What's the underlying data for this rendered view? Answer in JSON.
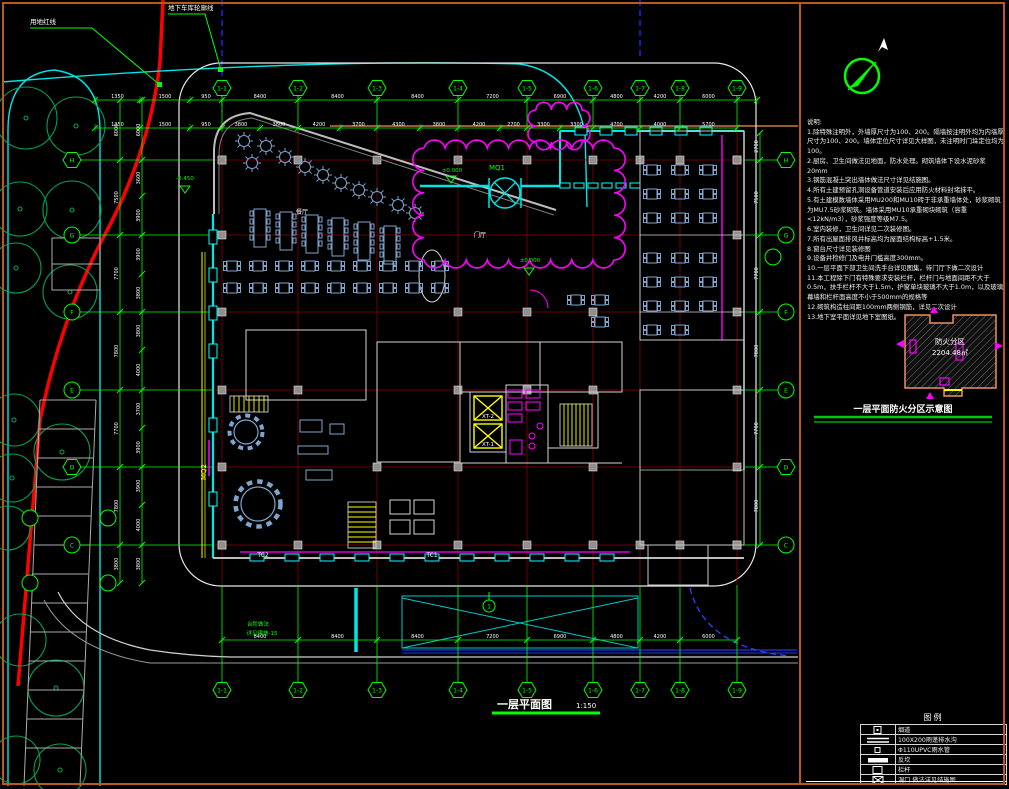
{
  "frame": {
    "border_color": "#b65a1f"
  },
  "site": {
    "red_line_label": "用地红线",
    "garage_label": "地下车库轮廓线"
  },
  "north": {
    "label": "北"
  },
  "plan": {
    "title": "一层平面图",
    "scale": "1:150",
    "detail_marker": "1",
    "grid_x": [
      222,
      298,
      377,
      458,
      527,
      593,
      640,
      680,
      737
    ],
    "grid_x_labels": [
      "1-1",
      "1-2",
      "1-3",
      "1-4",
      "1-5",
      "1-6",
      "1-7",
      "1-8",
      "1-9"
    ],
    "grid_y": [
      160,
      235,
      312,
      390,
      467,
      545
    ],
    "grid_y_labels": [
      "H",
      "G",
      "F",
      "E",
      "D",
      "C"
    ],
    "grid_y_extra": [
      518,
      583
    ],
    "dims": {
      "top1": {
        "y": 100,
        "ticks": [
          95,
          140,
          190,
          222,
          298,
          377,
          458,
          527,
          593,
          640,
          680,
          737,
          757
        ],
        "values": [
          "1350",
          "1500",
          "950",
          "8400",
          "8400",
          "8400",
          "7200",
          "6900",
          "4800",
          "4200",
          "6000",
          ""
        ]
      },
      "top2": {
        "y": 128,
        "ticks": [
          95,
          140,
          190,
          222,
          260,
          298,
          340,
          377,
          420,
          458,
          500,
          527,
          560,
          593,
          640,
          680,
          737
        ],
        "values": [
          "1350",
          "1500",
          "950",
          "3800",
          "3800",
          "4200",
          "3700",
          "4300",
          "3800",
          "4200",
          "2700",
          "3300",
          "3300",
          "4700",
          "4000",
          "5700"
        ]
      },
      "bottom": {
        "y": 640,
        "ticks": [
          222,
          298,
          377,
          458,
          527,
          593,
          640,
          680,
          737
        ],
        "values": [
          "8400",
          "8400",
          "8400",
          "7200",
          "6900",
          "4800",
          "4200",
          "6000"
        ]
      },
      "left1": {
        "x": 120,
        "ticks": [
          100,
          160,
          235,
          312,
          390,
          467,
          545,
          583
        ],
        "values": [
          "6000",
          "7500",
          "7700",
          "7800",
          "7700",
          "7800",
          "3800"
        ]
      },
      "left2": {
        "x": 142,
        "ticks": [
          100,
          160,
          196,
          235,
          274,
          312,
          350,
          390,
          428,
          467,
          505,
          545,
          583
        ],
        "values": [
          "6000",
          "3600",
          "3900",
          "3900",
          "3800",
          "3800",
          "4000",
          "3700",
          "3900",
          "3900",
          "4000",
          "3800"
        ]
      },
      "right1": {
        "x": 760,
        "ticks": [
          133,
          160,
          235,
          312,
          390,
          467,
          545
        ],
        "values": [
          "2700",
          "7500",
          "7700",
          "7800",
          "7700",
          "7800"
        ]
      }
    },
    "labels": [
      {
        "x": 497,
        "y": 170,
        "t": "MQ1",
        "c": "#00ff00",
        "s": 7
      },
      {
        "x": 206,
        "y": 472,
        "t": "MQ2",
        "c": "#ffff00",
        "s": 7,
        "rot": -90
      },
      {
        "x": 263,
        "y": 557,
        "t": "TC2",
        "c": "#ffffff",
        "s": 6
      },
      {
        "x": 432,
        "y": 557,
        "t": "TC1",
        "c": "#ffffff",
        "s": 6
      },
      {
        "x": 488,
        "y": 418,
        "t": "XT-2",
        "c": "#ffffff",
        "s": 5.5
      },
      {
        "x": 488,
        "y": 446,
        "t": "XT-1",
        "c": "#ffffff",
        "s": 5.5
      },
      {
        "x": 452,
        "y": 172,
        "t": "±0.000",
        "c": "#00ff00",
        "s": 5.5
      },
      {
        "x": 530,
        "y": 262,
        "t": "±0.000",
        "c": "#00ff00",
        "s": 5.5
      },
      {
        "x": 185,
        "y": 180,
        "t": "-0.450",
        "c": "#00ff00",
        "s": 5.5
      },
      {
        "x": 258,
        "y": 626,
        "t": "台阶做法",
        "c": "#00ff00",
        "s": 5.5
      },
      {
        "x": 262,
        "y": 635,
        "t": "详见建施-15",
        "c": "#00ff00",
        "s": 5.5
      },
      {
        "x": 302,
        "y": 214,
        "t": "餐厅",
        "c": "#ffffff",
        "s": 6
      },
      {
        "x": 480,
        "y": 237,
        "t": "门厅",
        "c": "#ffffff",
        "s": 6
      }
    ]
  },
  "notes": {
    "title": "说明:",
    "items": [
      "1.除特殊注明外，外墙厚尺寸为100、200。隔墙按注明外均为内墙厚尺寸为100、200。墙体定位尺寸详见大样图，未注明时门垛定位均为100。",
      "2.厨房、卫生间做法见地面，防水处理。砌筑墙体下设水泥砂浆20mm",
      "3.钢筋混凝土突出墙体做法尺寸详见结施图。",
      "4.所有土建预留孔洞设备管道安装后应用防火材料封堵抹平。",
      "5.有土建模数墙体采用MU200和MU10砖于非承重墙体处，砂浆砌筑为MU7.5砂浆砌筑。墙体采用MU10承重砌块砌筑（容重<12kN/m3），砂浆强度等级M7.5。",
      "6.室内装修，卫生间详见二次装修图。",
      "7.所有出屋面排风井标高均为屋面结构标高+1.5米。",
      "8.窗台尺寸详见装修图",
      "9.设备井检修门及电井门槛高度300mm。",
      "10.一层平面下部卫生间洗手台详见图集，待门厅下做二次设计",
      "11.本工程除下门有特殊要求安装栏杆，栏杆门与地面间距不大于0.5m，扶手栏杆不大于1.5m，护窗单块玻璃不大于1.0m，以及玻璃幕墙和栏杆面高度不小于500mm的规格等",
      "12.砌筑构造柱间距100mm两侧钢筋，详见二次设计",
      "13.地下室平面详见地下室图纸。"
    ]
  },
  "fire": {
    "zone_label": "防火分区",
    "zone_area": "2204.48㎡",
    "title": "一层平面防火分区示意图"
  },
  "legend": {
    "title": "图例",
    "rows": [
      {
        "sym": "flue",
        "text": "烟道"
      },
      {
        "sym": "gutter",
        "text": "100X200雨蓬排水沟"
      },
      {
        "sym": "pipe",
        "text": "Φ110UPVC雨水管"
      },
      {
        "sym": "curb",
        "text": "反坎"
      },
      {
        "sym": "rail",
        "text": "栏杆"
      },
      {
        "sym": "hole",
        "text": "洞口 做法详见结施图"
      }
    ]
  }
}
